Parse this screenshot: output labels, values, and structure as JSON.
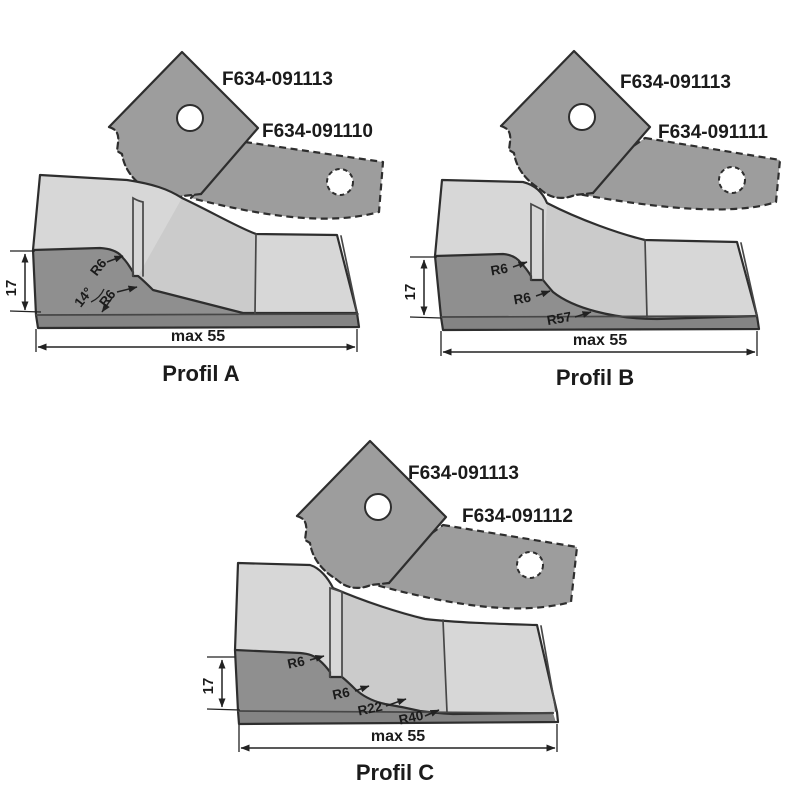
{
  "figure": {
    "background": "#ffffff",
    "colors": {
      "knife_fill": "#9d9d9d",
      "top_face": "#d7d7d7",
      "front_face": "#8f8f8f",
      "base_edge": "#848484",
      "outline": "#2e2e2e",
      "text": "#1b1b1b",
      "dim_line": "#222222"
    }
  },
  "profiles": [
    {
      "title": "Profil A",
      "knife_labels": [
        "F634-091113",
        "F634-091110"
      ],
      "height_dim": "17",
      "width_dim": "max 55",
      "annotations": [
        "R6",
        "14°",
        "R6"
      ]
    },
    {
      "title": "Profil B",
      "knife_labels": [
        "F634-091113",
        "F634-091111"
      ],
      "height_dim": "17",
      "width_dim": "max 55",
      "annotations": [
        "R6",
        "R6",
        "R57"
      ]
    },
    {
      "title": "Profil C",
      "knife_labels": [
        "F634-091113",
        "F634-091112"
      ],
      "height_dim": "17",
      "width_dim": "max 55",
      "annotations": [
        "R6",
        "R6",
        "R22",
        "R40"
      ]
    }
  ]
}
